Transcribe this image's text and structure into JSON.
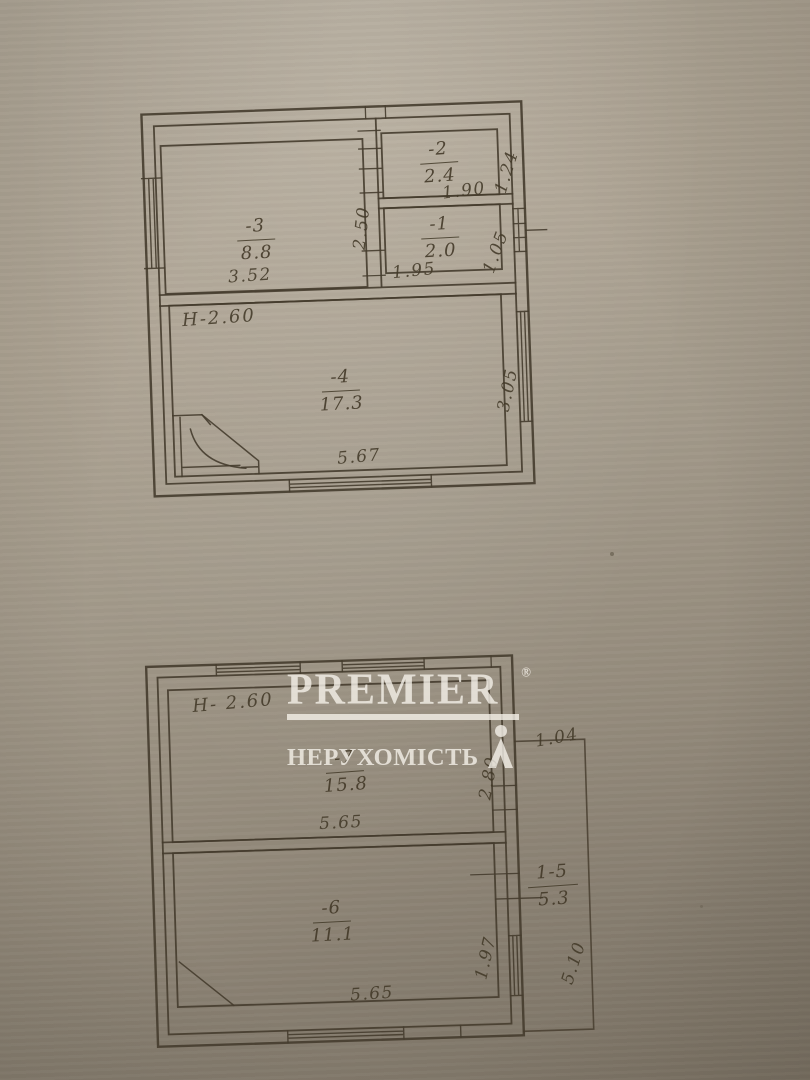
{
  "watermark": {
    "brand": "PREMIER",
    "registered": "®",
    "subtitle": "НЕРУХОМІСТЬ"
  },
  "upper_plan": {
    "height_label": "H-2.60",
    "rooms": [
      {
        "number": "-3",
        "area": "8.8"
      },
      {
        "number": "-2",
        "area": "2.4"
      },
      {
        "number": "-1",
        "area": "2.0"
      },
      {
        "number": "-4",
        "area": "17.3"
      }
    ],
    "dims": {
      "room3_width": "3.52",
      "room3_depth": "2.50",
      "room2_width": "1.90",
      "room2_depth": "1.24",
      "room1_width": "1.95",
      "room1_depth": "1.05",
      "room4_width": "5.67",
      "room4_depth": "3.05"
    }
  },
  "lower_plan": {
    "height_label": "H- 2.60",
    "rooms": [
      {
        "number": "-7",
        "area": "15.8"
      },
      {
        "number": "-6",
        "area": "11.1"
      },
      {
        "number": "1-5",
        "area": "5.3"
      }
    ],
    "dims": {
      "room7_width": "5.65",
      "room7_depth": "2.80",
      "room6_width": "5.65",
      "room6_depth": "1.97",
      "annex_width": "1.04",
      "annex_depth": "5.10"
    }
  }
}
